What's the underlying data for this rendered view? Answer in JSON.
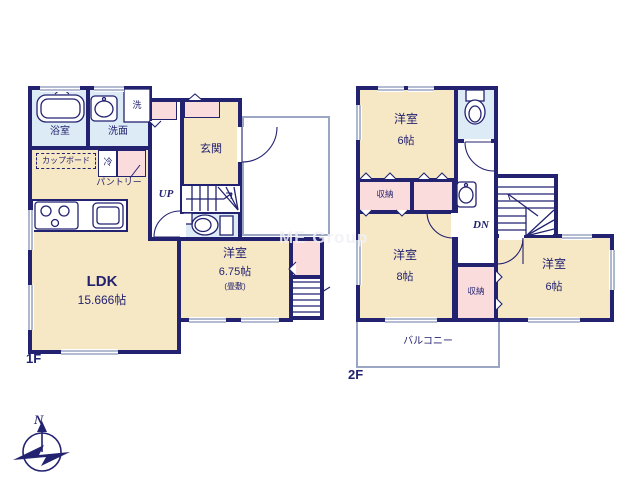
{
  "watermark": "ME Group",
  "compass": {
    "north": "N"
  },
  "colors": {
    "wall": "#232270",
    "room_fill": "#f7e8c5",
    "closet_fill": "#fadcdc",
    "wet_area_fill": "#dcebf5",
    "outline_thin": "#9aa6c4"
  },
  "floor1": {
    "label": "1F",
    "bath": "浴室",
    "washroom": "洗面",
    "washer": "洗",
    "cupboard": "カップボード",
    "fridge": "冷",
    "pantry": "パントリー",
    "entrance": "玄関",
    "stairs": "UP",
    "ldk": {
      "name": "LDK",
      "size": "15.666帖"
    },
    "bedroom": {
      "name": "洋室",
      "size": "6.75帖",
      "note": "(畳敷)"
    }
  },
  "floor2": {
    "label": "2F",
    "bedroom1": {
      "name": "洋室",
      "size": "6帖"
    },
    "storage1": "収納",
    "bedroom2": {
      "name": "洋室",
      "size": "8帖"
    },
    "storage2": "収納",
    "bedroom3": {
      "name": "洋室",
      "size": "6帖"
    },
    "stairs": "DN",
    "balcony": "バルコニー"
  }
}
